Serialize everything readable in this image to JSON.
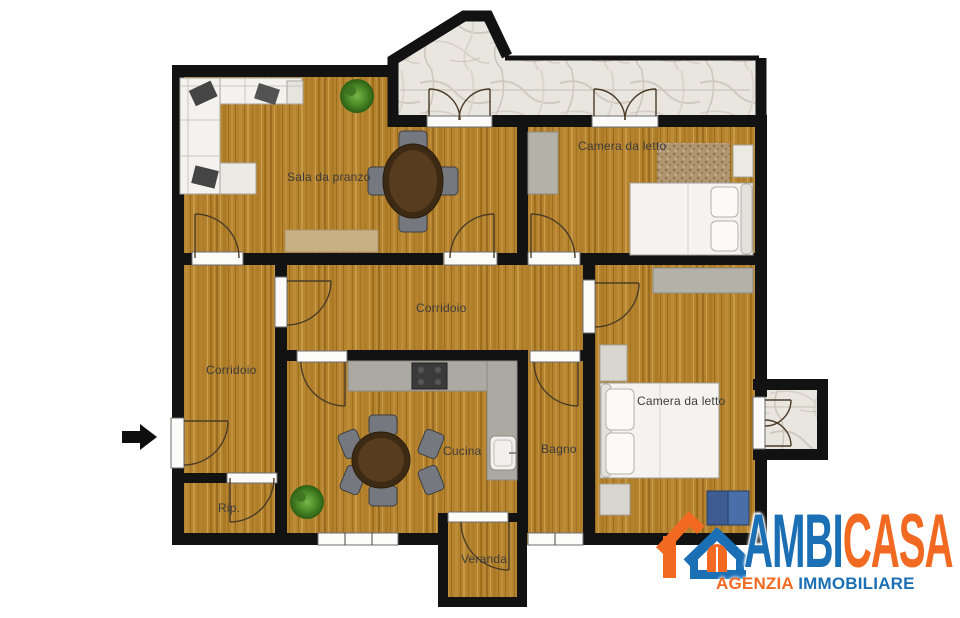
{
  "floorplan": {
    "rooms": {
      "sala_da_pranzo": "Sala da pranzo",
      "camera_da_letto_1": "Camera da letto",
      "corridoio_1": "Corridoio",
      "corridoio_2": "Corridoio",
      "cucina": "Cucina",
      "bagno": "Bagno",
      "camera_da_letto_2": "Camera da letto",
      "ripostiglio": "Rip.",
      "veranda": "Veranda"
    },
    "icons": {
      "entrance_arrow": "right-arrow"
    },
    "colors": {
      "wall": "#121212",
      "wood_floor": "#b5832e",
      "marble": "#e9e5df"
    }
  },
  "logo": {
    "name_blue": "AMBI",
    "name_orange": "CASA",
    "tagline_orange": "AGENZIA",
    "tagline_blue": "IMMOBILIARE",
    "color_blue": "#1b6fb5",
    "color_orange": "#f26a21"
  }
}
